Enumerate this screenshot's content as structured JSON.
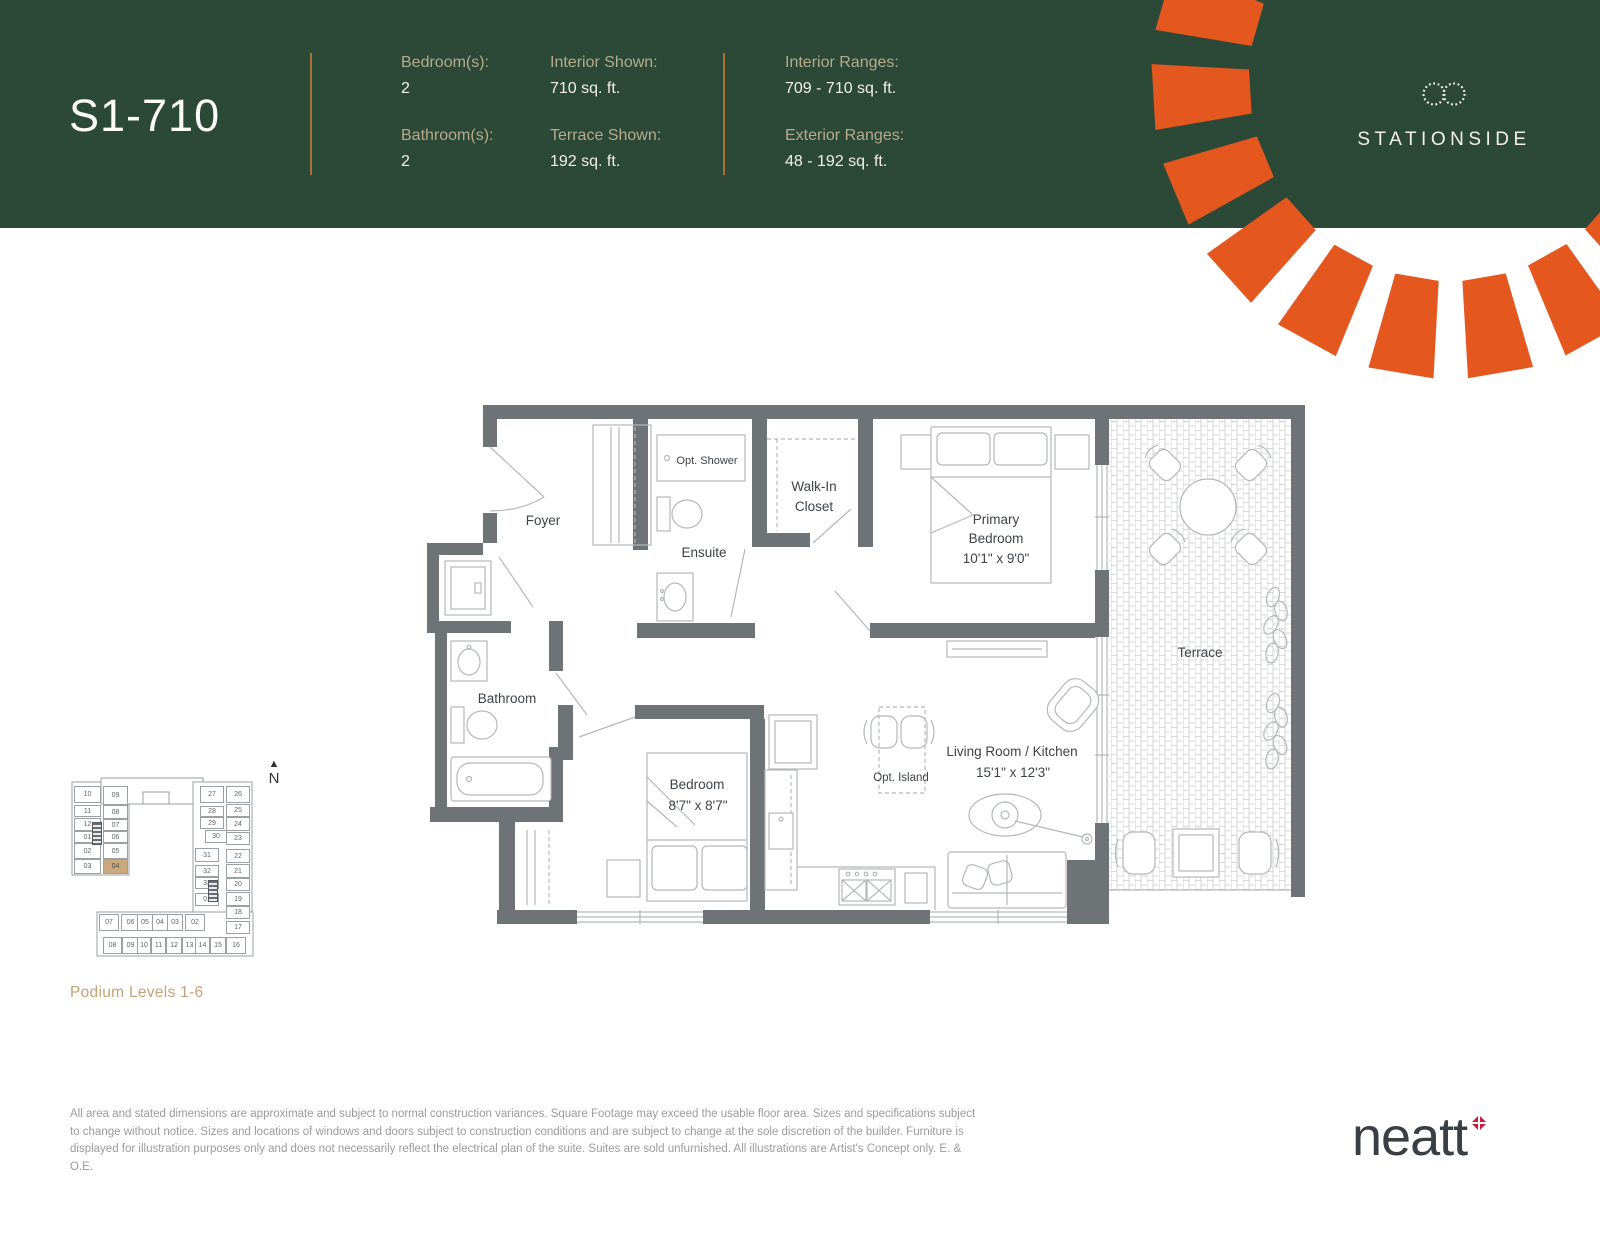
{
  "colors": {
    "green": "#2c4938",
    "orange": "#e4571f",
    "copper": "#a96f3c",
    "tan": "#b6ab8c",
    "ivory": "#f3f0e6",
    "wall": "#6e7376",
    "line": "#b4b8ba",
    "ptext": "#3f4346",
    "kline": "#9aa0a3",
    "ktext": "#606568",
    "khl": "#c9a87e",
    "podium": "#c3a377",
    "dim": "#9b9b9b",
    "neatt": "#3a3f45",
    "nred": "#c41f3f"
  },
  "header": {
    "title": "S1-710",
    "col1": [
      {
        "label": "Bedroom(s):",
        "value": "2"
      },
      {
        "label": "Bathroom(s):",
        "value": "2"
      }
    ],
    "col2": [
      {
        "label": "Interior Shown:",
        "value": "710 sq. ft."
      },
      {
        "label": "Terrace Shown:",
        "value": "192 sq. ft."
      }
    ],
    "col3": [
      {
        "label": "Interior Ranges:",
        "value": "709 - 710 sq. ft."
      },
      {
        "label": "Exterior Ranges:",
        "value": "48 - 192 sq. ft."
      }
    ],
    "brand": "STATIONSIDE"
  },
  "plan": {
    "foyer": "Foyer",
    "opt_shower": "Opt. Shower",
    "ensuite": "Ensuite",
    "walk_in_line1": "Walk-In",
    "walk_in_line2": "Closet",
    "primary_line1": "Primary",
    "primary_line2": "Bedroom",
    "primary_dims": "10'1\" x 9'0\"",
    "bathroom": "Bathroom",
    "bedroom": "Bedroom",
    "bedroom_dims": "8'7\" x 8'7\"",
    "living": "Living Room / Kitchen",
    "living_dims": "15'1\" x 12'3\"",
    "opt_island": "Opt. Island",
    "terrace": "Terrace"
  },
  "keyplan": {
    "north": "N",
    "caption": "Podium Levels 1-6",
    "units": [
      {
        "n": "10",
        "x": 16,
        "y": 36,
        "w": 27,
        "h": 17
      },
      {
        "n": "11",
        "x": 16,
        "y": 55,
        "w": 27,
        "h": 12
      },
      {
        "n": "12",
        "x": 16,
        "y": 68,
        "w": 27,
        "h": 13
      },
      {
        "n": "01",
        "x": 16,
        "y": 81,
        "w": 27,
        "h": 12
      },
      {
        "n": "02",
        "x": 16,
        "y": 93,
        "w": 27,
        "h": 16
      },
      {
        "n": "03",
        "x": 16,
        "y": 109,
        "w": 27,
        "h": 15
      },
      {
        "n": "09",
        "x": 45,
        "y": 36,
        "w": 25,
        "h": 19
      },
      {
        "n": "08",
        "x": 45,
        "y": 55,
        "w": 25,
        "h": 14
      },
      {
        "n": "07",
        "x": 45,
        "y": 69,
        "w": 25,
        "h": 12
      },
      {
        "n": "06",
        "x": 45,
        "y": 81,
        "w": 25,
        "h": 12
      },
      {
        "n": "05",
        "x": 45,
        "y": 93,
        "w": 25,
        "h": 16
      },
      {
        "n": "04",
        "x": 45,
        "y": 109,
        "w": 25,
        "h": 15,
        "hl": true
      },
      {
        "n": "27",
        "x": 142,
        "y": 36,
        "w": 24,
        "h": 17
      },
      {
        "n": "28",
        "x": 142,
        "y": 56,
        "w": 24,
        "h": 11
      },
      {
        "n": "29",
        "x": 142,
        "y": 67,
        "w": 24,
        "h": 12
      },
      {
        "n": "30",
        "x": 147,
        "y": 80,
        "w": 22,
        "h": 13
      },
      {
        "n": "31",
        "x": 137,
        "y": 98,
        "w": 24,
        "h": 14
      },
      {
        "n": "32",
        "x": 137,
        "y": 115,
        "w": 24,
        "h": 12
      },
      {
        "n": "33",
        "x": 137,
        "y": 127,
        "w": 24,
        "h": 12
      },
      {
        "n": "01",
        "x": 137,
        "y": 143,
        "w": 24,
        "h": 13
      },
      {
        "n": "26",
        "x": 168,
        "y": 36,
        "w": 24,
        "h": 17
      },
      {
        "n": "25",
        "x": 168,
        "y": 54,
        "w": 24,
        "h": 13
      },
      {
        "n": "24",
        "x": 168,
        "y": 67,
        "w": 24,
        "h": 14
      },
      {
        "n": "23",
        "x": 168,
        "y": 82,
        "w": 24,
        "h": 13
      },
      {
        "n": "22",
        "x": 168,
        "y": 99,
        "w": 24,
        "h": 14
      },
      {
        "n": "21",
        "x": 168,
        "y": 114,
        "w": 24,
        "h": 14
      },
      {
        "n": "20",
        "x": 168,
        "y": 128,
        "w": 24,
        "h": 13
      },
      {
        "n": "19",
        "x": 168,
        "y": 142,
        "w": 24,
        "h": 14
      },
      {
        "n": "18",
        "x": 168,
        "y": 156,
        "w": 24,
        "h": 13
      },
      {
        "n": "17",
        "x": 168,
        "y": 171,
        "w": 24,
        "h": 13
      },
      {
        "n": "07",
        "x": 41,
        "y": 164,
        "w": 20,
        "h": 17
      },
      {
        "n": "06",
        "x": 63,
        "y": 164,
        "w": 19,
        "h": 17
      },
      {
        "n": "05",
        "x": 79,
        "y": 164,
        "w": 16,
        "h": 17
      },
      {
        "n": "04",
        "x": 94,
        "y": 164,
        "w": 16,
        "h": 17
      },
      {
        "n": "03",
        "x": 109,
        "y": 164,
        "w": 16,
        "h": 17
      },
      {
        "n": "02",
        "x": 127,
        "y": 164,
        "w": 20,
        "h": 17
      },
      {
        "n": "08",
        "x": 45,
        "y": 187,
        "w": 19,
        "h": 17
      },
      {
        "n": "09",
        "x": 64,
        "y": 187,
        "w": 17,
        "h": 17
      },
      {
        "n": "10",
        "x": 79,
        "y": 187,
        "w": 14,
        "h": 17
      },
      {
        "n": "11",
        "x": 93,
        "y": 187,
        "w": 15,
        "h": 17
      },
      {
        "n": "12",
        "x": 108,
        "y": 187,
        "w": 16,
        "h": 17
      },
      {
        "n": "13",
        "x": 124,
        "y": 187,
        "w": 15,
        "h": 17
      },
      {
        "n": "14",
        "x": 137,
        "y": 187,
        "w": 15,
        "h": 17
      },
      {
        "n": "15",
        "x": 152,
        "y": 187,
        "w": 16,
        "h": 17
      },
      {
        "n": "16",
        "x": 168,
        "y": 187,
        "w": 20,
        "h": 17
      }
    ]
  },
  "footer": {
    "disclaimer_lines": [
      "All area and stated dimensions are approximate and subject to normal construction variances. Square Footage may exceed the usable floor area. Sizes and specifications subject",
      "to change without notice. Sizes and locations of windows and doors subject to construction conditions and are subject to change at the sole discretion of the builder. Furniture is",
      "displayed for illustration purposes only and does not necessarily reflect the electrical plan of the suite. Suites are sold unfurnished. All illustrations are Artist's Concept only. E. & O.E."
    ],
    "brand": "neatt"
  }
}
